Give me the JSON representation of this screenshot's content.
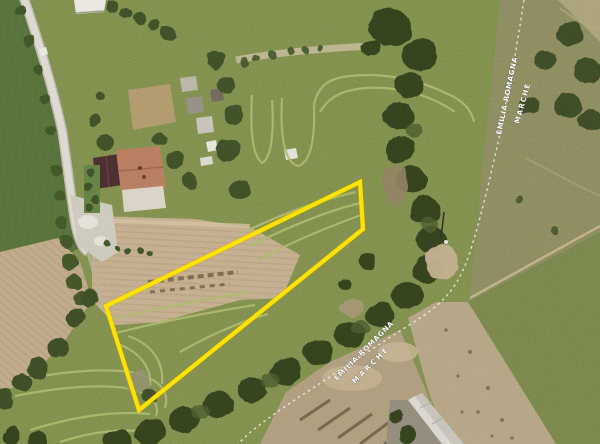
{
  "map": {
    "type": "satellite-aerial-view",
    "region_labels": {
      "upper_pair": {
        "line1": "EMILIA-ROMAGNA",
        "line2": "MARCHE"
      },
      "lower_pair": {
        "line1": "EMILIA-ROMAGNA",
        "line2": "MARCHE"
      }
    },
    "parcel": {
      "outline_color": "#ffe100",
      "points": "360,182 363,229 139,410 106,306"
    },
    "boundary": {
      "style": "dashed",
      "color": "#ffffff",
      "path": "M524,0 C516,52 508,98 500,134 C490,178 482,214 470,252 C460,282 448,300 420,318 C392,336 352,362 316,386 C288,404 262,422 246,436 L238,444"
    },
    "palette": {
      "main_grass": "#7b8a4b",
      "dark_field": "#546d38",
      "olive_field": "#87875c",
      "plowed_soil": "#c1ab89",
      "bare_soil": "#ab9878",
      "trees": "#33401f",
      "road": "#dad8ce",
      "red_roof": "#b4775c",
      "dark_roof": "#472c2d",
      "track_line": "#aab76a"
    }
  }
}
